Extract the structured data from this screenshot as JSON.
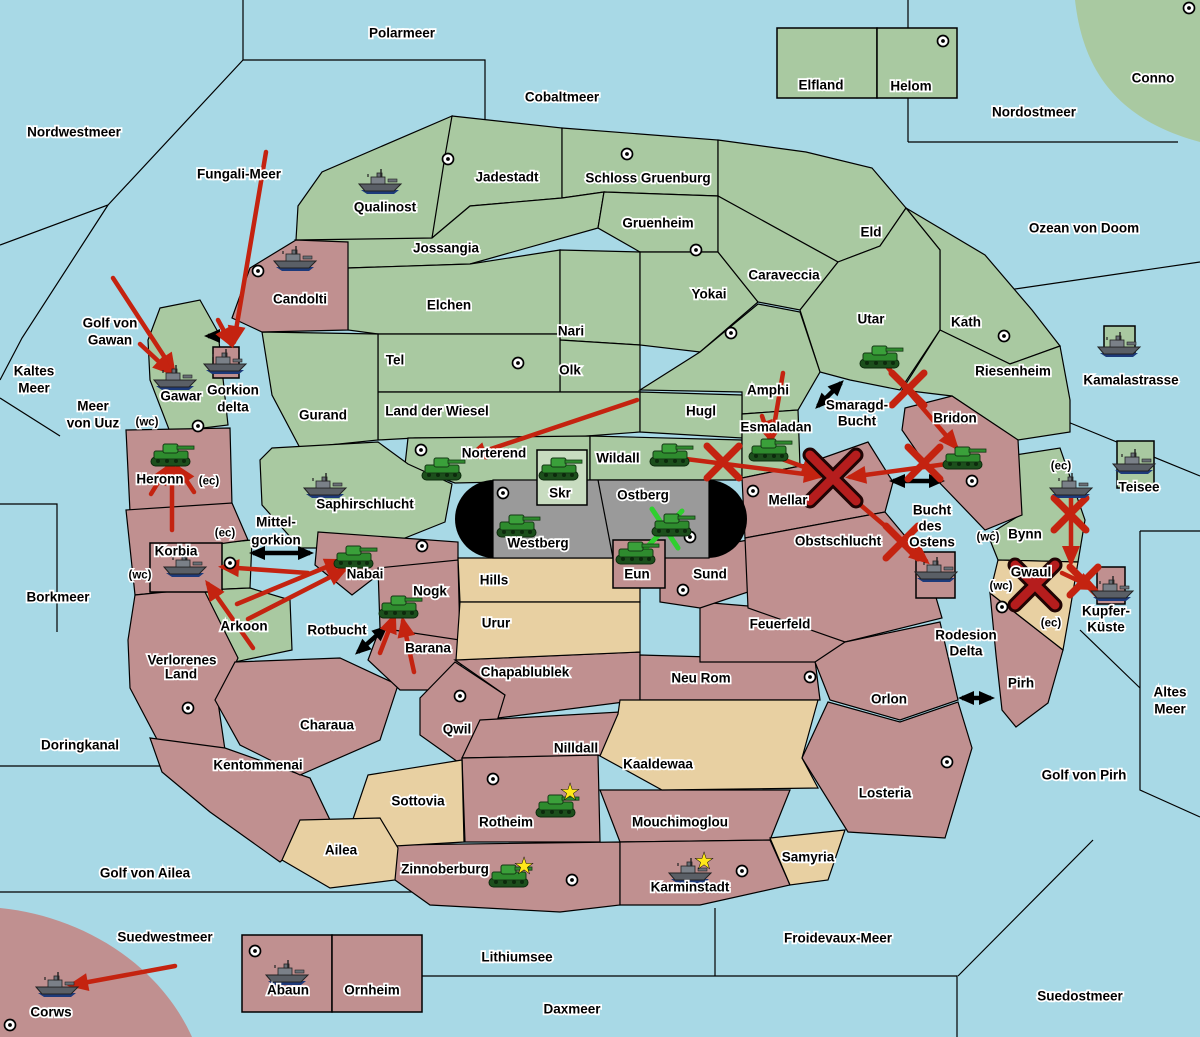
{
  "map": {
    "colors": {
      "sea": "#a8d9e6",
      "green": "#a9c9a1",
      "red": "#c09090",
      "tan": "#e8d0a2",
      "gray": "#9a9a9a",
      "skr_box": "#c8dcc0",
      "arrow_red": "#c42310",
      "battle_x": "#b51d1d",
      "support_green": "#2fcf2f",
      "star": "#ffe81a",
      "strait_arrow": "#000000"
    },
    "labels": [
      {
        "t": "Polarmeer",
        "x": 402,
        "y": 33
      },
      {
        "t": "Cobaltmeer",
        "x": 562,
        "y": 97
      },
      {
        "t": "Nordostmeer",
        "x": 1034,
        "y": 112
      },
      {
        "t": "Nordwestmeer",
        "x": 74,
        "y": 132
      },
      {
        "t": "Fungali-Meer",
        "x": 239,
        "y": 174
      },
      {
        "t": "Ozean von Doom",
        "x": 1084,
        "y": 228
      },
      {
        "t": "Conno",
        "x": 1153,
        "y": 78
      },
      {
        "t": "Kaltes",
        "x": 34,
        "y": 371
      },
      {
        "t": "Meer",
        "x": 34,
        "y": 388
      },
      {
        "t": "Meer",
        "x": 93,
        "y": 406
      },
      {
        "t": "von Uuz",
        "x": 93,
        "y": 423
      },
      {
        "t": "Golf von",
        "x": 110,
        "y": 323
      },
      {
        "t": "Gawan",
        "x": 110,
        "y": 340
      },
      {
        "t": "Borkmeer",
        "x": 58,
        "y": 597
      },
      {
        "t": "Doringkanal",
        "x": 80,
        "y": 745
      },
      {
        "t": "Golf von Ailea",
        "x": 145,
        "y": 873
      },
      {
        "t": "Suedwestmeer",
        "x": 165,
        "y": 937
      },
      {
        "t": "Corws",
        "x": 51,
        "y": 1012
      },
      {
        "t": "Lithiumsee",
        "x": 517,
        "y": 957
      },
      {
        "t": "Daxmeer",
        "x": 572,
        "y": 1009
      },
      {
        "t": "Froidevaux-Meer",
        "x": 838,
        "y": 938
      },
      {
        "t": "Suedostmeer",
        "x": 1080,
        "y": 996
      },
      {
        "t": "Golf von Pirh",
        "x": 1084,
        "y": 775
      },
      {
        "t": "Altes",
        "x": 1170,
        "y": 692
      },
      {
        "t": "Meer",
        "x": 1170,
        "y": 709
      },
      {
        "t": "Kamalastrasse",
        "x": 1131,
        "y": 380
      },
      {
        "t": "Teisee",
        "x": 1139,
        "y": 487
      },
      {
        "t": "Smaragd-",
        "x": 857,
        "y": 405
      },
      {
        "t": "Bucht",
        "x": 857,
        "y": 421
      },
      {
        "t": "Bucht",
        "x": 932,
        "y": 510
      },
      {
        "t": "des",
        "x": 930,
        "y": 526
      },
      {
        "t": "Ostens",
        "x": 932,
        "y": 542
      },
      {
        "t": "Mittel-",
        "x": 276,
        "y": 522
      },
      {
        "t": "gorkion",
        "x": 276,
        "y": 540
      },
      {
        "t": "Rotbucht",
        "x": 337,
        "y": 630
      },
      {
        "t": "Rodesion",
        "x": 966,
        "y": 635
      },
      {
        "t": "Delta",
        "x": 966,
        "y": 651
      },
      {
        "t": "Gorkion",
        "x": 233,
        "y": 390
      },
      {
        "t": "delta",
        "x": 233,
        "y": 407
      },
      {
        "t": "Qualinost",
        "x": 385,
        "y": 207
      },
      {
        "t": "Jadestadt",
        "x": 507,
        "y": 177
      },
      {
        "t": "Schloss Gruenburg",
        "x": 648,
        "y": 178
      },
      {
        "t": "Elfland",
        "x": 821,
        "y": 85
      },
      {
        "t": "Helom",
        "x": 911,
        "y": 86
      },
      {
        "t": "Jossangia",
        "x": 446,
        "y": 248
      },
      {
        "t": "Gruenheim",
        "x": 658,
        "y": 223
      },
      {
        "t": "Elchen",
        "x": 449,
        "y": 305
      },
      {
        "t": "Nari",
        "x": 571,
        "y": 331
      },
      {
        "t": "Olk",
        "x": 570,
        "y": 370
      },
      {
        "t": "Tel",
        "x": 395,
        "y": 360
      },
      {
        "t": "Land der Wiesel",
        "x": 437,
        "y": 411
      },
      {
        "t": "Hugl",
        "x": 701,
        "y": 411
      },
      {
        "t": "Yokai",
        "x": 709,
        "y": 294
      },
      {
        "t": "Caraveccia",
        "x": 784,
        "y": 275
      },
      {
        "t": "Eld",
        "x": 871,
        "y": 232
      },
      {
        "t": "Utar",
        "x": 871,
        "y": 319
      },
      {
        "t": "Kath",
        "x": 966,
        "y": 322
      },
      {
        "t": "Riesenheim",
        "x": 1013,
        "y": 371
      },
      {
        "t": "Candolti",
        "x": 300,
        "y": 299
      },
      {
        "t": "Gurand",
        "x": 323,
        "y": 415
      },
      {
        "t": "Amphi",
        "x": 768,
        "y": 390
      },
      {
        "t": "Esmaladan",
        "x": 776,
        "y": 427
      },
      {
        "t": "Norterend",
        "x": 494,
        "y": 453
      },
      {
        "t": "Wildall",
        "x": 618,
        "y": 458
      },
      {
        "t": "Skr",
        "x": 560,
        "y": 493
      },
      {
        "t": "Ostberg",
        "x": 643,
        "y": 495
      },
      {
        "t": "Westberg",
        "x": 538,
        "y": 543
      },
      {
        "t": "Mellar",
        "x": 788,
        "y": 500
      },
      {
        "t": "Obstschlucht",
        "x": 838,
        "y": 541
      },
      {
        "t": "Bridon",
        "x": 955,
        "y": 418
      },
      {
        "t": "Bynn",
        "x": 1025,
        "y": 534
      },
      {
        "t": "Gwaul",
        "x": 1031,
        "y": 572
      },
      {
        "t": "Kupfer-",
        "x": 1106,
        "y": 611
      },
      {
        "t": "Küste",
        "x": 1106,
        "y": 627
      },
      {
        "t": "Pirh",
        "x": 1021,
        "y": 683
      },
      {
        "t": "Heronn",
        "x": 160,
        "y": 479
      },
      {
        "t": "Korbia",
        "x": 176,
        "y": 551
      },
      {
        "t": "Gawar",
        "x": 181,
        "y": 396
      },
      {
        "t": "Saphirschlucht",
        "x": 365,
        "y": 504
      },
      {
        "t": "Arkoon",
        "x": 244,
        "y": 626
      },
      {
        "t": "Nabai",
        "x": 365,
        "y": 574
      },
      {
        "t": "Nogk",
        "x": 430,
        "y": 591
      },
      {
        "t": "Barana",
        "x": 428,
        "y": 648
      },
      {
        "t": "Hills",
        "x": 494,
        "y": 580
      },
      {
        "t": "Urur",
        "x": 496,
        "y": 623
      },
      {
        "t": "Eun",
        "x": 637,
        "y": 574
      },
      {
        "t": "Sund",
        "x": 710,
        "y": 574
      },
      {
        "t": "Feuerfeld",
        "x": 780,
        "y": 624
      },
      {
        "t": "Verlorenes",
        "x": 182,
        "y": 660
      },
      {
        "t": "Land",
        "x": 181,
        "y": 674
      },
      {
        "t": "Kentommenai",
        "x": 258,
        "y": 765
      },
      {
        "t": "Charaua",
        "x": 327,
        "y": 725
      },
      {
        "t": "Chapablublek",
        "x": 525,
        "y": 672
      },
      {
        "t": "Qwil",
        "x": 457,
        "y": 729
      },
      {
        "t": "Nilldall",
        "x": 576,
        "y": 748
      },
      {
        "t": "Neu Rom",
        "x": 701,
        "y": 678
      },
      {
        "t": "Kaaldewaa",
        "x": 658,
        "y": 764
      },
      {
        "t": "Sottovia",
        "x": 418,
        "y": 801
      },
      {
        "t": "Rotheim",
        "x": 506,
        "y": 822
      },
      {
        "t": "Mouchimoglou",
        "x": 680,
        "y": 822
      },
      {
        "t": "Ailea",
        "x": 341,
        "y": 850
      },
      {
        "t": "Zinnoberburg",
        "x": 445,
        "y": 869
      },
      {
        "t": "Karminstadt",
        "x": 690,
        "y": 887
      },
      {
        "t": "Samyria",
        "x": 808,
        "y": 857
      },
      {
        "t": "Orlon",
        "x": 889,
        "y": 699
      },
      {
        "t": "Losteria",
        "x": 885,
        "y": 793
      },
      {
        "t": "Abaun",
        "x": 288,
        "y": 990
      },
      {
        "t": "Ornheim",
        "x": 372,
        "y": 990
      },
      {
        "t": "(wc)",
        "x": 147,
        "y": 421,
        "s": 1
      },
      {
        "t": "(ec)",
        "x": 209,
        "y": 480,
        "s": 1
      },
      {
        "t": "(ec)",
        "x": 225,
        "y": 532,
        "s": 1
      },
      {
        "t": "(wc)",
        "x": 140,
        "y": 574,
        "s": 1
      },
      {
        "t": "(ec)",
        "x": 1061,
        "y": 465,
        "s": 1
      },
      {
        "t": "(wc)",
        "x": 988,
        "y": 536,
        "s": 1
      },
      {
        "t": "(wc)",
        "x": 1001,
        "y": 585,
        "s": 1
      },
      {
        "t": "(ec)",
        "x": 1051,
        "y": 622,
        "s": 1
      }
    ],
    "insets": [
      {
        "n": "elfland-box",
        "x": 777,
        "y": 28,
        "w": 100,
        "h": 70,
        "c": "green"
      },
      {
        "n": "helom-box",
        "x": 877,
        "y": 28,
        "w": 80,
        "h": 70,
        "c": "green"
      },
      {
        "n": "skr-box",
        "x": 537,
        "y": 450,
        "w": 50,
        "h": 55,
        "c": "skr_box"
      },
      {
        "n": "gorkion-delta-box",
        "x": 213,
        "y": 347,
        "w": 26,
        "h": 31,
        "c": "red"
      },
      {
        "n": "borkmeer-box",
        "x": 150,
        "y": 543,
        "w": 72,
        "h": 49,
        "c": "red"
      },
      {
        "n": "eun-box",
        "x": 613,
        "y": 540,
        "w": 52,
        "h": 48,
        "c": "red"
      },
      {
        "n": "bucht-des-ostens-box",
        "x": 916,
        "y": 552,
        "w": 39,
        "h": 46,
        "c": "red"
      },
      {
        "n": "teisee-box",
        "x": 1117,
        "y": 441,
        "w": 37,
        "h": 47,
        "c": "green"
      },
      {
        "n": "kamalastrasse-box",
        "x": 1104,
        "y": 326,
        "w": 31,
        "h": 27,
        "c": "green"
      },
      {
        "n": "kupfer-kueste-box",
        "x": 1097,
        "y": 567,
        "w": 28,
        "h": 37,
        "c": "red"
      },
      {
        "n": "abaun-box",
        "x": 242,
        "y": 935,
        "w": 90,
        "h": 77,
        "c": "red"
      },
      {
        "n": "ornheim-box",
        "x": 332,
        "y": 935,
        "w": 90,
        "h": 77,
        "c": "red"
      }
    ],
    "supply_centers": [
      {
        "x": 448,
        "y": 159
      },
      {
        "x": 627,
        "y": 154
      },
      {
        "x": 943,
        "y": 41
      },
      {
        "x": 1189,
        "y": 8
      },
      {
        "x": 258,
        "y": 271
      },
      {
        "x": 696,
        "y": 250
      },
      {
        "x": 518,
        "y": 363
      },
      {
        "x": 731,
        "y": 333
      },
      {
        "x": 1004,
        "y": 336
      },
      {
        "x": 198,
        "y": 426
      },
      {
        "x": 230,
        "y": 563
      },
      {
        "x": 421,
        "y": 450
      },
      {
        "x": 503,
        "y": 493
      },
      {
        "x": 753,
        "y": 491
      },
      {
        "x": 690,
        "y": 537
      },
      {
        "x": 683,
        "y": 590
      },
      {
        "x": 972,
        "y": 481
      },
      {
        "x": 422,
        "y": 546
      },
      {
        "x": 188,
        "y": 708
      },
      {
        "x": 460,
        "y": 696
      },
      {
        "x": 493,
        "y": 779
      },
      {
        "x": 810,
        "y": 677
      },
      {
        "x": 947,
        "y": 762
      },
      {
        "x": 572,
        "y": 880
      },
      {
        "x": 742,
        "y": 871
      },
      {
        "x": 255,
        "y": 951
      },
      {
        "x": 10,
        "y": 1025
      },
      {
        "x": 1002,
        "y": 607
      }
    ],
    "units": [
      {
        "k": "fleet",
        "n": "qualinost",
        "x": 380,
        "y": 182
      },
      {
        "k": "fleet",
        "n": "candolti",
        "x": 295,
        "y": 259
      },
      {
        "k": "fleet",
        "n": "gawar",
        "x": 175,
        "y": 378
      },
      {
        "k": "fleet",
        "n": "gorkion-delta",
        "x": 225,
        "y": 362
      },
      {
        "k": "fleet",
        "n": "saphirschlucht",
        "x": 325,
        "y": 486
      },
      {
        "k": "fleet",
        "n": "borkmeer",
        "x": 185,
        "y": 565
      },
      {
        "k": "fleet",
        "n": "bucht-des-ostens",
        "x": 936,
        "y": 570
      },
      {
        "k": "fleet",
        "n": "bynn",
        "x": 1071,
        "y": 486
      },
      {
        "k": "fleet",
        "n": "teisee",
        "x": 1134,
        "y": 462
      },
      {
        "k": "fleet",
        "n": "kamalastrasse",
        "x": 1119,
        "y": 345
      },
      {
        "k": "fleet",
        "n": "kupfer-kueste",
        "x": 1112,
        "y": 589
      },
      {
        "k": "fleet",
        "n": "corws",
        "x": 57,
        "y": 985
      },
      {
        "k": "fleet",
        "n": "abaun",
        "x": 287,
        "y": 973
      },
      {
        "k": "fleet",
        "n": "karminstadt",
        "x": 690,
        "y": 871
      },
      {
        "k": "army",
        "n": "heronn",
        "x": 172,
        "y": 454
      },
      {
        "k": "army",
        "n": "nabai",
        "x": 355,
        "y": 556
      },
      {
        "k": "army",
        "n": "barana",
        "x": 400,
        "y": 606
      },
      {
        "k": "army",
        "n": "norterend",
        "x": 443,
        "y": 468
      },
      {
        "k": "army",
        "n": "skr",
        "x": 560,
        "y": 468
      },
      {
        "k": "army",
        "n": "westberg",
        "x": 518,
        "y": 525
      },
      {
        "k": "army",
        "n": "ostberg",
        "x": 673,
        "y": 524
      },
      {
        "k": "army",
        "n": "eun",
        "x": 637,
        "y": 552
      },
      {
        "k": "army",
        "n": "wildall",
        "x": 671,
        "y": 454
      },
      {
        "k": "army",
        "n": "esmaladan",
        "x": 770,
        "y": 449
      },
      {
        "k": "army",
        "n": "utar",
        "x": 881,
        "y": 356
      },
      {
        "k": "army",
        "n": "bridon",
        "x": 964,
        "y": 457
      },
      {
        "k": "army",
        "n": "rotheim",
        "x": 557,
        "y": 805
      },
      {
        "k": "army",
        "n": "zinnoberburg",
        "x": 510,
        "y": 875
      }
    ],
    "stars": [
      {
        "x": 570,
        "y": 792
      },
      {
        "x": 524,
        "y": 866
      },
      {
        "x": 704,
        "y": 861
      }
    ],
    "move_arrows": [
      {
        "x1": 113,
        "y1": 278,
        "x2": 173,
        "y2": 370
      },
      {
        "x1": 140,
        "y1": 344,
        "x2": 170,
        "y2": 372
      },
      {
        "x1": 266,
        "y1": 152,
        "x2": 234,
        "y2": 342
      },
      {
        "x1": 218,
        "y1": 320,
        "x2": 231,
        "y2": 344
      },
      {
        "x1": 172,
        "y1": 530,
        "x2": 172,
        "y2": 463
      },
      {
        "x1": 151,
        "y1": 494,
        "x2": 167,
        "y2": 468
      },
      {
        "x1": 194,
        "y1": 492,
        "x2": 178,
        "y2": 468
      },
      {
        "x1": 308,
        "y1": 573,
        "x2": 223,
        "y2": 567
      },
      {
        "x1": 253,
        "y1": 648,
        "x2": 208,
        "y2": 584
      },
      {
        "x1": 237,
        "y1": 604,
        "x2": 341,
        "y2": 561
      },
      {
        "x1": 248,
        "y1": 619,
        "x2": 344,
        "y2": 570
      },
      {
        "x1": 414,
        "y1": 672,
        "x2": 403,
        "y2": 621
      },
      {
        "x1": 380,
        "y1": 653,
        "x2": 394,
        "y2": 617
      },
      {
        "x1": 175,
        "y1": 966,
        "x2": 72,
        "y2": 985
      },
      {
        "x1": 637,
        "y1": 400,
        "x2": 470,
        "y2": 456
      },
      {
        "x1": 678,
        "y1": 458,
        "x2": 820,
        "y2": 476
      },
      {
        "x1": 779,
        "y1": 458,
        "x2": 818,
        "y2": 472
      },
      {
        "x1": 783,
        "y1": 373,
        "x2": 772,
        "y2": 438
      },
      {
        "x1": 762,
        "y1": 416,
        "x2": 769,
        "y2": 437
      },
      {
        "x1": 884,
        "y1": 363,
        "x2": 956,
        "y2": 447
      },
      {
        "x1": 954,
        "y1": 463,
        "x2": 850,
        "y2": 477
      },
      {
        "x1": 843,
        "y1": 490,
        "x2": 926,
        "y2": 561
      },
      {
        "x1": 1071,
        "y1": 497,
        "x2": 1071,
        "y2": 562
      },
      {
        "x1": 1062,
        "y1": 573,
        "x2": 1094,
        "y2": 588
      }
    ],
    "battle_marks": [
      {
        "x": 833,
        "y": 478,
        "r": 23,
        "big": true
      },
      {
        "x": 1035,
        "y": 585,
        "r": 20,
        "big": true
      },
      {
        "x": 723,
        "y": 462,
        "r": 16
      },
      {
        "x": 908,
        "y": 389,
        "r": 16
      },
      {
        "x": 924,
        "y": 463,
        "r": 16
      },
      {
        "x": 902,
        "y": 542,
        "r": 16
      },
      {
        "x": 1070,
        "y": 514,
        "r": 16
      },
      {
        "x": 1084,
        "y": 581,
        "r": 14
      }
    ],
    "support_marks": [
      {
        "x1": 652,
        "y1": 509,
        "x2": 678,
        "y2": 548
      },
      {
        "x1": 682,
        "y1": 511,
        "x2": 645,
        "y2": 549
      }
    ],
    "strait_arrows": [
      {
        "x1": 228,
        "y1": 336,
        "x2": 208,
        "y2": 336,
        "both": false
      },
      {
        "x1": 253,
        "y1": 553,
        "x2": 310,
        "y2": 553,
        "both": true
      },
      {
        "x1": 358,
        "y1": 652,
        "x2": 385,
        "y2": 628,
        "both": true
      },
      {
        "x1": 818,
        "y1": 406,
        "x2": 841,
        "y2": 383,
        "both": true
      },
      {
        "x1": 893,
        "y1": 481,
        "x2": 941,
        "y2": 481,
        "both": true
      },
      {
        "x1": 962,
        "y1": 698,
        "x2": 991,
        "y2": 698,
        "both": true
      }
    ]
  }
}
